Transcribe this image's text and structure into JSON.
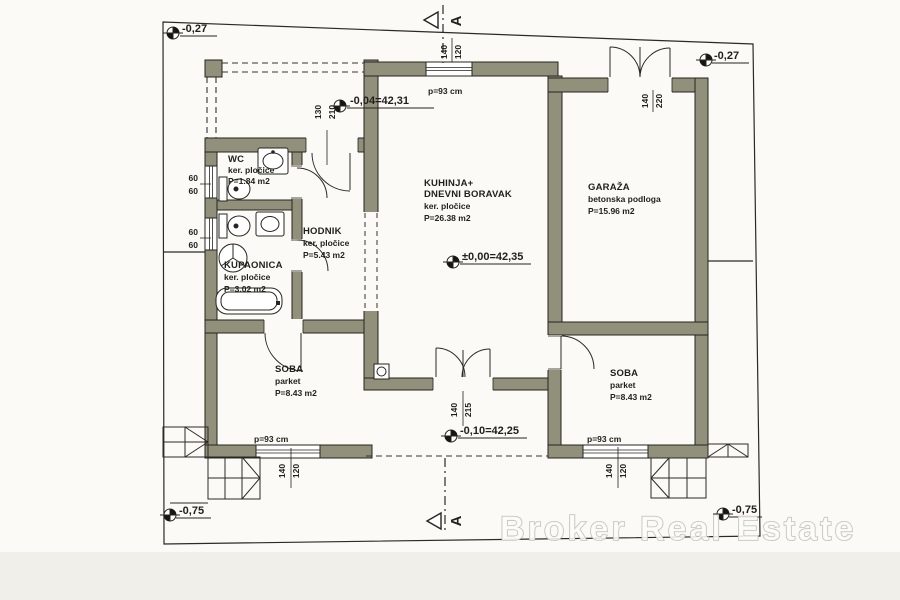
{
  "plan": {
    "watermark": "Broker Real Estate",
    "section": {
      "letter": "A"
    },
    "levels": {
      "site_top_left": "-0,27",
      "site_top_right": "-0,27",
      "terrace": "-0,04=42,31",
      "living": "±0,00=42,35",
      "entrance": "-0,10=42,25",
      "site_bottom_left": "-0,75",
      "site_bottom_right": "-0,75"
    },
    "rooms": {
      "wc": {
        "name": "WC",
        "floor": "ker. pločice",
        "area": "P=1.84 m2"
      },
      "hodnik": {
        "name": "HODNIK",
        "floor": "ker. pločice",
        "area": "P=5.43 m2"
      },
      "kupaonica": {
        "name": "KUPAONICA",
        "floor": "ker. pločice",
        "area": "P=3.02 m2"
      },
      "kuhinja": {
        "name": "KUHINJA+",
        "name2": "DNEVNI BORAVAK",
        "floor": "ker. pločice",
        "area": "P=26.38 m2"
      },
      "garaza": {
        "name": "GARAŽA",
        "floor": "betonska podloga",
        "area": "P=15.96 m2"
      },
      "soba_left": {
        "name": "SOBA",
        "floor": "parket",
        "area": "P=8.43 m2"
      },
      "soba_right": {
        "name": "SOBA",
        "floor": "parket",
        "area": "P=8.43 m2"
      }
    },
    "openings": {
      "kitchen_window": {
        "w": "140",
        "h": "120",
        "parapet": "p=93 cm"
      },
      "entry_door": {
        "w": "130",
        "h": "210"
      },
      "garage_door": {
        "w": "140",
        "h": "220"
      },
      "main_door": {
        "w": "140",
        "h": "215"
      },
      "soba_left_window": {
        "w": "140",
        "h": "120",
        "parapet": "p=93 cm"
      },
      "soba_right_window": {
        "w": "140",
        "h": "120",
        "parapet": "p=93 cm"
      },
      "wc_window": {
        "w": "60",
        "h": "60"
      },
      "bath_window": {
        "w": "60",
        "h": "60"
      }
    },
    "colors": {
      "wall": "#90907b",
      "line": "#26251f",
      "paper": "#fbfaf6",
      "watermark": "#b9b8b1"
    }
  }
}
